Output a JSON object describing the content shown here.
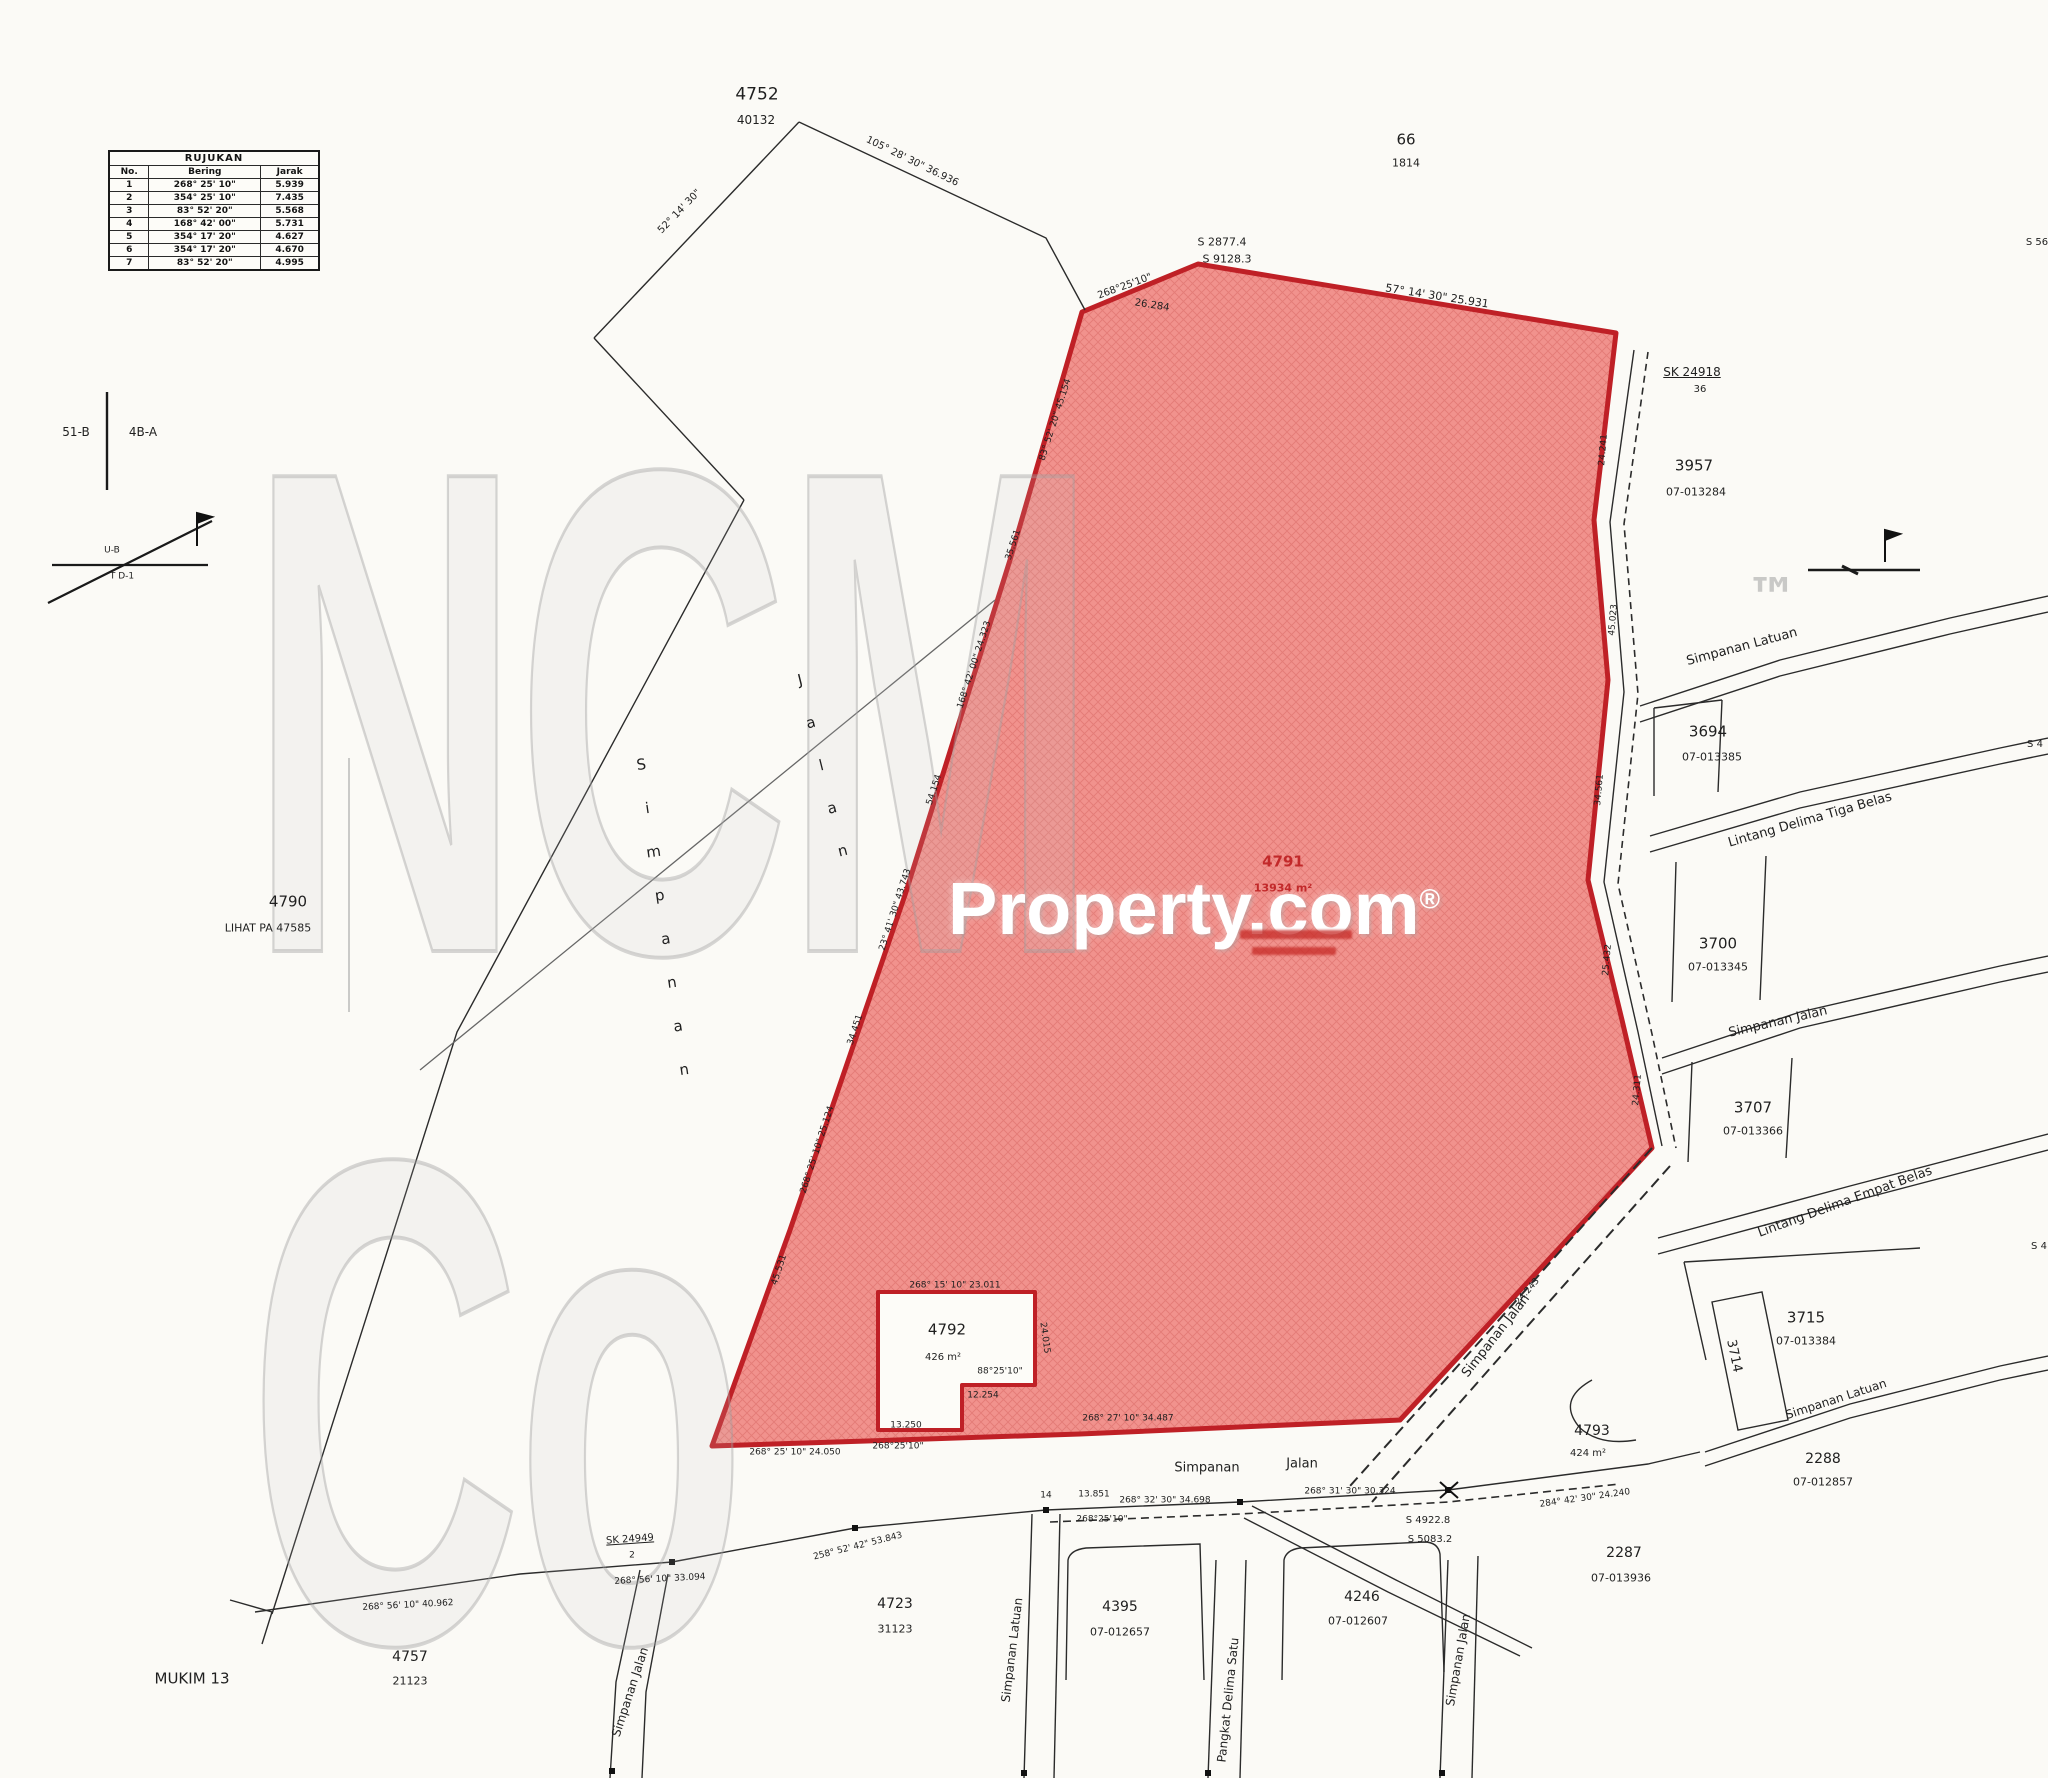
{
  "reference_table": {
    "title": "RUJUKAN",
    "headers": [
      "No.",
      "Bering",
      "Jarak"
    ],
    "rows": [
      [
        "1",
        "268° 25' 10\"",
        "5.939"
      ],
      [
        "2",
        "354° 25' 10\"",
        "7.435"
      ],
      [
        "3",
        "83° 52' 20\"",
        "5.568"
      ],
      [
        "4",
        "168° 42' 00\"",
        "5.731"
      ],
      [
        "5",
        "354° 17' 20\"",
        "4.627"
      ],
      [
        "6",
        "354° 17' 20\"",
        "4.670"
      ],
      [
        "7",
        "83° 52' 20\"",
        "4.995"
      ]
    ]
  },
  "watermark": {
    "brand": "NCM Co",
    "tm": "™",
    "property": "Property.com",
    "reg": "®"
  },
  "highlight": {
    "fill": "#f1928d",
    "hatch": "#d96b65",
    "border": "#bf2026",
    "label_color": "#c2292a"
  },
  "labels": [
    {
      "name": "lot-4752",
      "text": "4752",
      "x": 757,
      "y": 95,
      "size": 17
    },
    {
      "name": "lot-4752-ref",
      "text": "40132",
      "x": 756,
      "y": 120,
      "size": 12
    },
    {
      "name": "lot-66",
      "text": "66",
      "x": 1406,
      "y": 140,
      "size": 15
    },
    {
      "name": "lot-66-ref",
      "text": "1814",
      "x": 1406,
      "y": 163,
      "size": 11
    },
    {
      "name": "datum-s2877",
      "text": "S 2877.4",
      "x": 1222,
      "y": 242,
      "size": 11
    },
    {
      "name": "datum-s9128",
      "text": "S 9128.3",
      "x": 1227,
      "y": 259,
      "size": 11
    },
    {
      "name": "bearing-apex-left",
      "text": "268°25'10\"",
      "x": 1125,
      "y": 287,
      "size": 10,
      "rot": -20
    },
    {
      "name": "bearing-top-right",
      "text": "57° 14' 30\" 25.931",
      "x": 1437,
      "y": 296,
      "size": 11,
      "rot": 9
    },
    {
      "name": "dim-apex",
      "text": "26.284",
      "x": 1152,
      "y": 306,
      "size": 10,
      "rot": 9
    },
    {
      "name": "bearing-top-line",
      "text": "105° 28' 30\" 36.936",
      "x": 912,
      "y": 162,
      "size": 10,
      "rot": 26
    },
    {
      "name": "bearing-top-line-2",
      "text": "52° 14' 30\"",
      "x": 680,
      "y": 212,
      "size": 10,
      "rot": -46
    },
    {
      "name": "mark-sk24918",
      "text": "SK 24918",
      "x": 1692,
      "y": 372,
      "size": 12,
      "underline": true
    },
    {
      "name": "mark-sk24918-b",
      "text": "36",
      "x": 1700,
      "y": 390,
      "size": 10
    },
    {
      "name": "lot-3957",
      "text": "3957",
      "x": 1694,
      "y": 466,
      "size": 15
    },
    {
      "name": "lot-3957-ref",
      "text": "07-013284",
      "x": 1696,
      "y": 492,
      "size": 11
    },
    {
      "name": "road-simpanan-latuan-top",
      "text": "Simpanan Latuan",
      "x": 1742,
      "y": 647,
      "size": 13,
      "rot": -15
    },
    {
      "name": "lot-3694",
      "text": "3694",
      "x": 1708,
      "y": 732,
      "size": 15
    },
    {
      "name": "lot-3694-ref",
      "text": "07-013385",
      "x": 1712,
      "y": 757,
      "size": 11
    },
    {
      "name": "road-lintang-delima-tiga-belas",
      "text": "Lintang Delima Tiga Belas",
      "x": 1810,
      "y": 820,
      "size": 13,
      "rot": -16
    },
    {
      "name": "lot-3700",
      "text": "3700",
      "x": 1718,
      "y": 944,
      "size": 15
    },
    {
      "name": "lot-3700-ref",
      "text": "07-013345",
      "x": 1718,
      "y": 967,
      "size": 11
    },
    {
      "name": "road-simpanan-jalan-mid",
      "text": "Simpanan Jalan",
      "x": 1778,
      "y": 1022,
      "size": 13,
      "rot": -13
    },
    {
      "name": "lot-3707",
      "text": "3707",
      "x": 1753,
      "y": 1108,
      "size": 15
    },
    {
      "name": "lot-3707-ref",
      "text": "07-013366",
      "x": 1753,
      "y": 1131,
      "size": 11
    },
    {
      "name": "road-lintang-delima-empat-belas",
      "text": "Lintang Delima Empat Belas",
      "x": 1845,
      "y": 1202,
      "size": 13,
      "rot": -20
    },
    {
      "name": "lot-3715",
      "text": "3715",
      "x": 1806,
      "y": 1318,
      "size": 15
    },
    {
      "name": "lot-3715-ref",
      "text": "07-013384",
      "x": 1806,
      "y": 1341,
      "size": 11
    },
    {
      "name": "lot-3714",
      "text": "3714",
      "x": 1734,
      "y": 1356,
      "size": 13,
      "rot": 78
    },
    {
      "name": "road-simpanan-latuan-low",
      "text": "Simpanan Latuan",
      "x": 1836,
      "y": 1399,
      "size": 12,
      "rot": -18
    },
    {
      "name": "lot-2288",
      "text": "2288",
      "x": 1823,
      "y": 1459,
      "size": 14
    },
    {
      "name": "lot-2288-ref",
      "text": "07-012857",
      "x": 1823,
      "y": 1482,
      "size": 11
    },
    {
      "name": "lot-2287",
      "text": "2287",
      "x": 1624,
      "y": 1553,
      "size": 14
    },
    {
      "name": "lot-2287-ref",
      "text": "07-013936",
      "x": 1621,
      "y": 1578,
      "size": 11
    },
    {
      "name": "lot-4793",
      "text": "4793",
      "x": 1592,
      "y": 1431,
      "size": 14
    },
    {
      "name": "lot-4793-area",
      "text": "424 m²",
      "x": 1588,
      "y": 1454,
      "size": 10
    },
    {
      "name": "road-simpanan-jalan-diag",
      "text": "Simpanan Jalan",
      "x": 1496,
      "y": 1336,
      "size": 13,
      "rot": -52
    },
    {
      "name": "lot-4791",
      "text": "4791",
      "x": 1283,
      "y": 862,
      "size": 15,
      "color": "#c2292a",
      "weight": 700
    },
    {
      "name": "lot-4791-area",
      "text": "13934 m²",
      "x": 1283,
      "y": 888,
      "size": 11,
      "color": "#c2292a",
      "weight": 700
    },
    {
      "name": "lot-4790",
      "text": "4790",
      "x": 288,
      "y": 902,
      "size": 15
    },
    {
      "name": "lot-4790-note",
      "text": "LIHAT PA 47585",
      "x": 268,
      "y": 928,
      "size": 11
    },
    {
      "name": "lot-4792",
      "text": "4792",
      "x": 947,
      "y": 1330,
      "size": 15
    },
    {
      "name": "lot-4792-area",
      "text": "426 m²",
      "x": 943,
      "y": 1358,
      "size": 10
    },
    {
      "name": "bearing-4792-top",
      "text": "268° 15' 10\" 23.011",
      "x": 955,
      "y": 1286,
      "size": 9
    },
    {
      "name": "bearing-4792-88",
      "text": "88°25'10\"",
      "x": 1000,
      "y": 1372,
      "size": 9
    },
    {
      "name": "dim-4792-12254",
      "text": "12.254",
      "x": 983,
      "y": 1396,
      "size": 9
    },
    {
      "name": "dim-4792-13250",
      "text": "13.250",
      "x": 906,
      "y": 1426,
      "size": 9
    },
    {
      "name": "bearing-4792-268",
      "text": "268°25'10\"",
      "x": 898,
      "y": 1447,
      "size": 9
    },
    {
      "name": "dim-4792-right",
      "text": "24.015",
      "x": 1044,
      "y": 1338,
      "size": 9,
      "rot": 82
    },
    {
      "name": "bearing-bottom-left",
      "text": "268° 25' 10\" 24.050",
      "x": 795,
      "y": 1453,
      "size": 9
    },
    {
      "name": "bearing-bottom-mid",
      "text": "268° 27' 10\" 34.487",
      "x": 1128,
      "y": 1419,
      "size": 9
    },
    {
      "name": "dim-diag-edge",
      "text": "24.243",
      "x": 1528,
      "y": 1292,
      "size": 9,
      "rot": -49
    },
    {
      "name": "road-simpanan-bottom",
      "text": "Simpanan",
      "x": 1207,
      "y": 1468,
      "size": 13
    },
    {
      "name": "road-jalan-bottom",
      "text": "Jalan",
      "x": 1302,
      "y": 1464,
      "size": 13
    },
    {
      "name": "dim-road-14",
      "text": "14",
      "x": 1046,
      "y": 1496,
      "size": 9
    },
    {
      "name": "dim-road-13851",
      "text": "13.851",
      "x": 1094,
      "y": 1495,
      "size": 9
    },
    {
      "name": "bearing-road-268",
      "text": "268°25'10\"",
      "x": 1102,
      "y": 1520,
      "size": 9
    },
    {
      "name": "bearing-road-34698",
      "text": "268° 32' 30\" 34.698",
      "x": 1165,
      "y": 1501,
      "size": 9
    },
    {
      "name": "bearing-road-30324",
      "text": "268° 31' 30\" 30.324",
      "x": 1350,
      "y": 1492,
      "size": 9
    },
    {
      "name": "datum-s4922",
      "text": "S 4922.8",
      "x": 1428,
      "y": 1521,
      "size": 10
    },
    {
      "name": "datum-s5083",
      "text": "S 5083.2",
      "x": 1430,
      "y": 1540,
      "size": 10
    },
    {
      "name": "bearing-road-24240",
      "text": "284° 42' 30\" 24.240",
      "x": 1585,
      "y": 1499,
      "size": 9,
      "rot": -8
    },
    {
      "name": "lot-4723",
      "text": "4723",
      "x": 895,
      "y": 1604,
      "size": 14
    },
    {
      "name": "lot-4723-ref",
      "text": "31123",
      "x": 895,
      "y": 1629,
      "size": 11
    },
    {
      "name": "lot-4395",
      "text": "4395",
      "x": 1120,
      "y": 1607,
      "size": 14
    },
    {
      "name": "lot-4395-ref",
      "text": "07-012657",
      "x": 1120,
      "y": 1632,
      "size": 11
    },
    {
      "name": "lot-4246",
      "text": "4246",
      "x": 1362,
      "y": 1597,
      "size": 14
    },
    {
      "name": "lot-4246-ref",
      "text": "07-012607",
      "x": 1358,
      "y": 1621,
      "size": 11
    },
    {
      "name": "road-simpanan-latuan-vert",
      "text": "Simpanan Latuan",
      "x": 1012,
      "y": 1650,
      "size": 12,
      "rot": -83
    },
    {
      "name": "road-pangkat-delima-satu",
      "text": "Pangkat Delima Satu",
      "x": 1228,
      "y": 1700,
      "size": 12,
      "rot": -84
    },
    {
      "name": "road-simpanan-jalan-vert",
      "text": "Simpanan Jalan",
      "x": 1458,
      "y": 1660,
      "size": 12,
      "rot": -80
    },
    {
      "name": "road-simpanan-jalan-bl",
      "text": "Simpanan Jalan",
      "x": 630,
      "y": 1692,
      "size": 12,
      "rot": -72
    },
    {
      "name": "mukim-13",
      "text": "MUKIM 13",
      "x": 192,
      "y": 1679,
      "size": 15
    },
    {
      "name": "lot-4757",
      "text": "4757",
      "x": 410,
      "y": 1657,
      "size": 14
    },
    {
      "name": "lot-4757-ref",
      "text": "21123",
      "x": 410,
      "y": 1681,
      "size": 11
    },
    {
      "name": "bearing-bl-40962",
      "text": "268° 56' 10\" 40.962",
      "x": 408,
      "y": 1606,
      "size": 9,
      "rot": -3
    },
    {
      "name": "bearing-bl-33094",
      "text": "268° 56' 10\" 33.094",
      "x": 660,
      "y": 1580,
      "size": 9,
      "rot": -3
    },
    {
      "name": "mark-sk24949",
      "text": "SK 24949",
      "x": 630,
      "y": 1540,
      "size": 10,
      "underline": true,
      "rot": -4
    },
    {
      "name": "mark-sk24949-b",
      "text": "2",
      "x": 632,
      "y": 1556,
      "size": 9
    },
    {
      "name": "bearing-bl-53843",
      "text": "258° 52' 42\" 53.843",
      "x": 858,
      "y": 1547,
      "size": 9,
      "rot": -14
    },
    {
      "name": "section-51b",
      "text": "51-B",
      "x": 76,
      "y": 432,
      "size": 12
    },
    {
      "name": "section-4ba",
      "text": "4B-A",
      "x": 143,
      "y": 432,
      "size": 12
    },
    {
      "name": "section-ub",
      "text": "U-B",
      "x": 112,
      "y": 551,
      "size": 9
    },
    {
      "name": "section-td1",
      "text": "T D-1",
      "x": 122,
      "y": 577,
      "size": 9
    },
    {
      "name": "road-simpanan-left",
      "text": "Simpanan",
      "x": 664,
      "y": 930,
      "size": 15,
      "vertical": true,
      "rot": -8
    },
    {
      "name": "road-jalan-left",
      "text": "Jalan",
      "x": 824,
      "y": 778,
      "size": 15,
      "vertical": true,
      "rot": -14
    },
    {
      "name": "edge-label-s56",
      "text": "S 56",
      "x": 2037,
      "y": 243,
      "size": 10
    },
    {
      "name": "edge-label-s4-a",
      "text": "S 4",
      "x": 2035,
      "y": 745,
      "size": 10
    },
    {
      "name": "edge-label-s4-b",
      "text": "S 4",
      "x": 2039,
      "y": 1247,
      "size": 10
    },
    {
      "name": "wm-tm",
      "text": "™",
      "x": 1772,
      "y": 598,
      "size": 52,
      "color": "rgba(160,160,160,0.55)",
      "weight": 700
    },
    {
      "name": "edge-bearing-l1",
      "text": "83° 52' 20\" 45.154",
      "x": 1056,
      "y": 420,
      "size": 9,
      "rot": -72
    },
    {
      "name": "edge-bearing-l2",
      "text": "35.561",
      "x": 1014,
      "y": 545,
      "size": 9,
      "rot": -72
    },
    {
      "name": "edge-bearing-l3",
      "text": "168° 42' 00\" 24.323",
      "x": 975,
      "y": 665,
      "size": 9,
      "rot": -72
    },
    {
      "name": "edge-bearing-l4",
      "text": "54.154",
      "x": 935,
      "y": 790,
      "size": 9,
      "rot": -72
    },
    {
      "name": "edge-bearing-l5",
      "text": "23° 41' 30\" 43.743",
      "x": 896,
      "y": 910,
      "size": 9,
      "rot": -72
    },
    {
      "name": "edge-bearing-l6",
      "text": "34.451",
      "x": 856,
      "y": 1030,
      "size": 9,
      "rot": -72
    },
    {
      "name": "edge-bearing-l7",
      "text": "268° 25' 10\" 25.124",
      "x": 818,
      "y": 1150,
      "size": 9,
      "rot": -72
    },
    {
      "name": "edge-bearing-l8",
      "text": "45.531",
      "x": 780,
      "y": 1270,
      "size": 9,
      "rot": -72
    },
    {
      "name": "edge-bearing-r1",
      "text": "24.241",
      "x": 1604,
      "y": 450,
      "size": 9,
      "rot": -85
    },
    {
      "name": "edge-bearing-r2",
      "text": "45.023",
      "x": 1614,
      "y": 620,
      "size": 9,
      "rot": -85
    },
    {
      "name": "edge-bearing-r3",
      "text": "34.561",
      "x": 1600,
      "y": 790,
      "size": 9,
      "rot": -85
    },
    {
      "name": "edge-bearing-r4",
      "text": "25.432",
      "x": 1608,
      "y": 960,
      "size": 9,
      "rot": -85
    },
    {
      "name": "edge-bearing-r5",
      "text": "24.311",
      "x": 1638,
      "y": 1090,
      "size": 9,
      "rot": -85
    }
  ]
}
